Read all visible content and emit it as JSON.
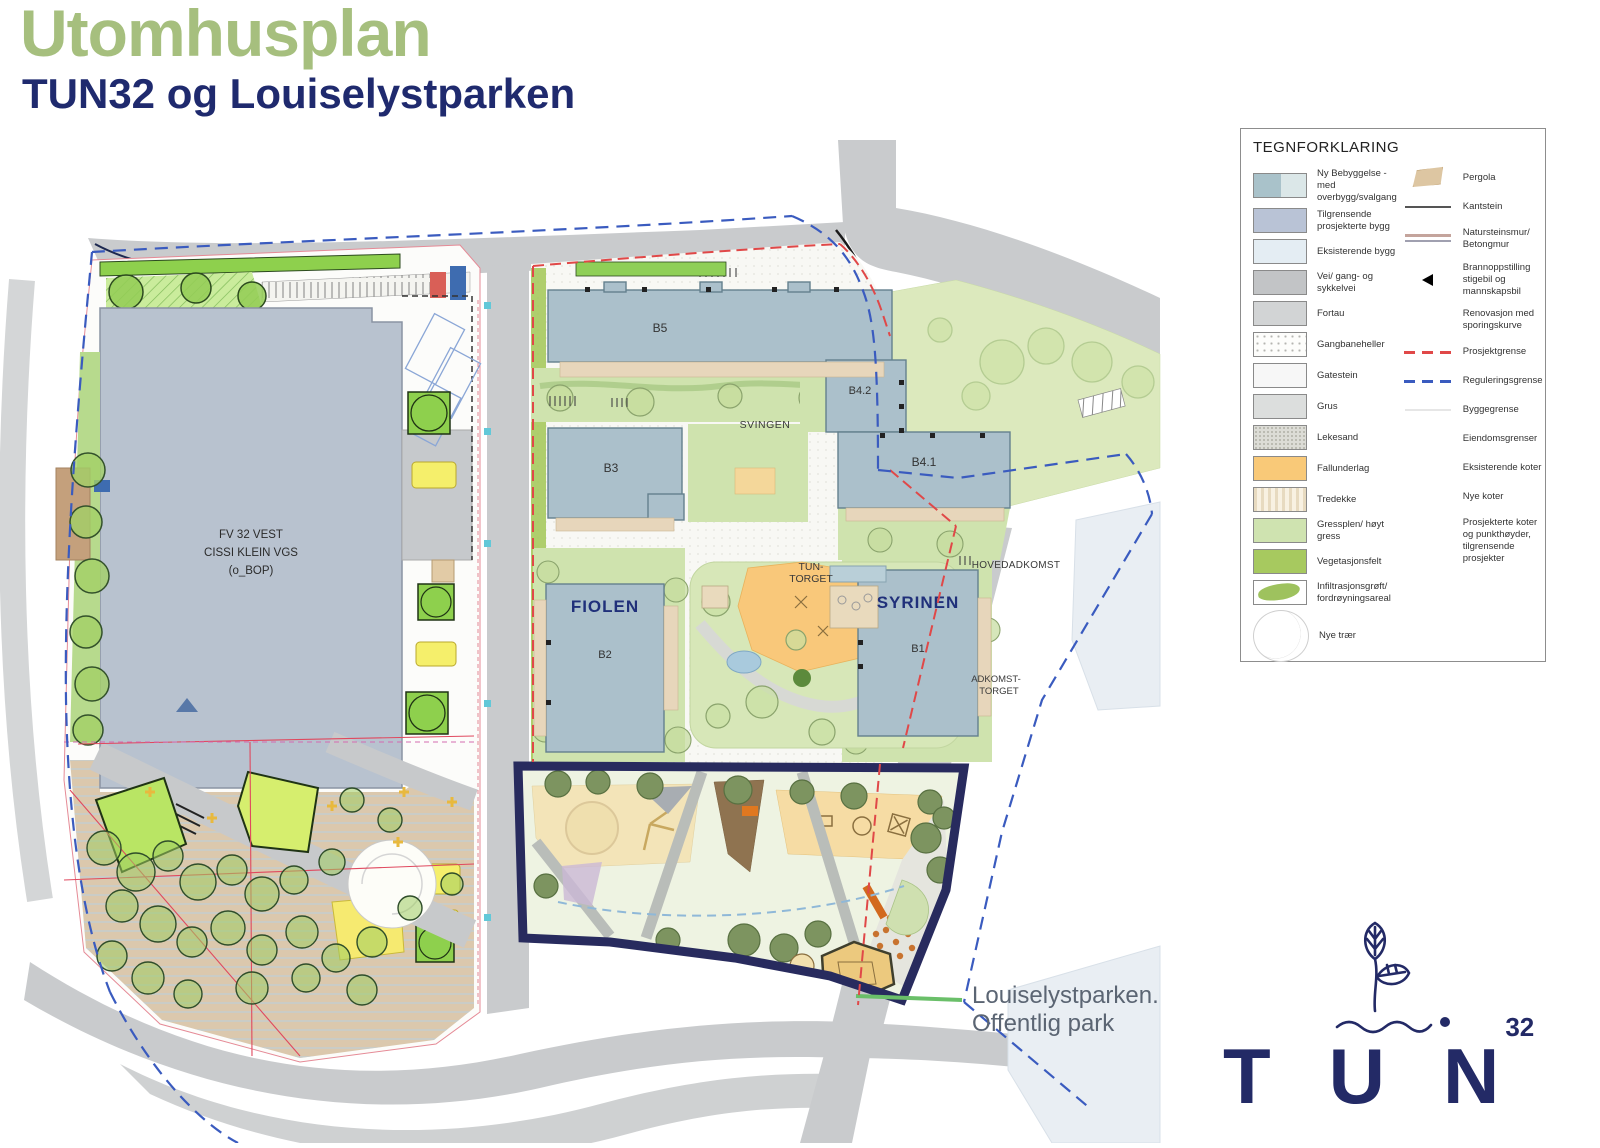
{
  "header": {
    "title": "Utomhusplan",
    "subtitle": "TUN32 og Louiselystparken"
  },
  "annotation": {
    "line1": "Louiselystparken.",
    "line2": "Offentlig park"
  },
  "map": {
    "labels": {
      "b5": "B5",
      "b42": "B4.2",
      "b3": "B3",
      "b41": "B4.1",
      "b2": "B2",
      "b1": "B1",
      "fiolen": "FIOLEN",
      "syrinen": "SYRINEN",
      "svingen": "SVINGEN",
      "tun_torget_1": "TUN-",
      "tun_torget_2": "TORGET",
      "hovedadkomst": "HOVEDADKOMST",
      "adkomst_torget_1": "ADKOMST-",
      "adkomst_torget_2": "TORGET",
      "school_1": "FV 32 VEST",
      "school_2": "CISSI KLEIN VGS",
      "school_3": "(o_BOP)"
    }
  },
  "legend": {
    "title": "TEGNFORKLARING",
    "left_items": [
      {
        "swatch": "two-tone",
        "label": "Ny Bebyggelse - med overbygg/svalgang"
      },
      {
        "swatch": "solid",
        "color": "#b9c3d6",
        "label": "Tilgrensende prosjekterte bygg"
      },
      {
        "swatch": "solid",
        "color": "#e4edf3",
        "label": "Eksisterende bygg"
      },
      {
        "swatch": "solid",
        "color": "#c2c4c6",
        "label": "Vei/ gang- og sykkelvei"
      },
      {
        "swatch": "solid",
        "color": "#d2d4d5",
        "label": "Fortau"
      },
      {
        "swatch": "dots",
        "label": "Gangbaneheller"
      },
      {
        "swatch": "solid",
        "color": "#f7f7f7",
        "label": "Gatestein"
      },
      {
        "swatch": "solid",
        "color": "#dcdedd",
        "label": "Grus"
      },
      {
        "swatch": "speckle",
        "label": "Lekesand"
      },
      {
        "swatch": "solid",
        "color": "#f9c978",
        "label": "Fallunderlag"
      },
      {
        "swatch": "stripes",
        "label": "Tredekke"
      },
      {
        "swatch": "solid",
        "color": "#cfe3b0",
        "label": "Gressplen/ høyt gress"
      },
      {
        "swatch": "solid",
        "color": "#a7c95f",
        "label": "Vegetasjonsfelt"
      },
      {
        "swatch": "blob",
        "label": "Infiltrasjonsgrøft/ fordrøyningsareal"
      },
      {
        "swatch": "tree",
        "label": "Nye trær"
      }
    ],
    "right_items": [
      {
        "symbol": "pergola",
        "label": "Pergola"
      },
      {
        "symbol": "line-dark",
        "label": "Kantstein"
      },
      {
        "symbol": "double-line",
        "label": "Natursteinsmur/ Betongmur"
      },
      {
        "symbol": "triangle",
        "label": "Brannoppstilling stigebil og mannskapsbil"
      },
      {
        "symbol": "none",
        "label": "Renovasjon med sporingskurve"
      },
      {
        "symbol": "dash-red",
        "label": "Prosjektgrense"
      },
      {
        "symbol": "dash-blue",
        "label": "Reguleringsgrense"
      },
      {
        "symbol": "line-faint",
        "label": "Byggegrense"
      },
      {
        "symbol": "none",
        "label": "Eiendomsgrenser"
      },
      {
        "symbol": "none",
        "label": "Eksisterende koter"
      },
      {
        "symbol": "none",
        "label": "Nye koter"
      },
      {
        "symbol": "none",
        "label": "Prosjekterte koter og punkthøyder, tilgrensende prosjekter"
      }
    ]
  },
  "logo": {
    "text": "TUN",
    "superscript": "32"
  },
  "colors": {
    "title_green": "#a6bf7e",
    "navy": "#232a66",
    "road_gray": "#c9cbcd",
    "new_building": "#abc0cb",
    "adjacent_building": "#b8c2cf",
    "existing_building": "#e9eef3",
    "lawn": "#dce9bd",
    "yard_green": "#cfe3ae",
    "vegetation": "#a7c95f",
    "fallunderlag": "#f9c87a",
    "park_border_navy": "#282b5e",
    "prosjektgrense_red": "#e04848",
    "reguleringsgrense_blue": "#3a5bbf",
    "leader_green": "#6abf69"
  }
}
